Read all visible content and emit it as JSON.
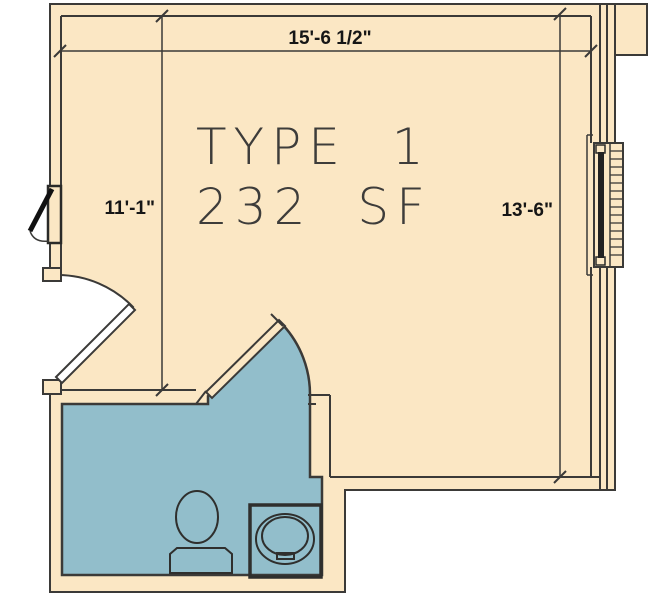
{
  "plan": {
    "unit_type_label": "TYPE 1",
    "unit_area_label": "232 SF",
    "dimensions": {
      "top_width": "15'-6 1/2\"",
      "left_height": "11'-1\"",
      "right_height": "13'-6\""
    },
    "rooms": {
      "main_room": "living area",
      "bathroom": "bathroom"
    },
    "fixtures": [
      "toilet",
      "sink",
      "window",
      "entry-door",
      "bathroom-door",
      "wall-vent"
    ],
    "colors": {
      "floor_fill": "#FBE7C4",
      "bathroom_fill": "#92BECB",
      "wall_line": "#3B3A38",
      "text": "#161616",
      "background": "#FFFFFF"
    }
  }
}
